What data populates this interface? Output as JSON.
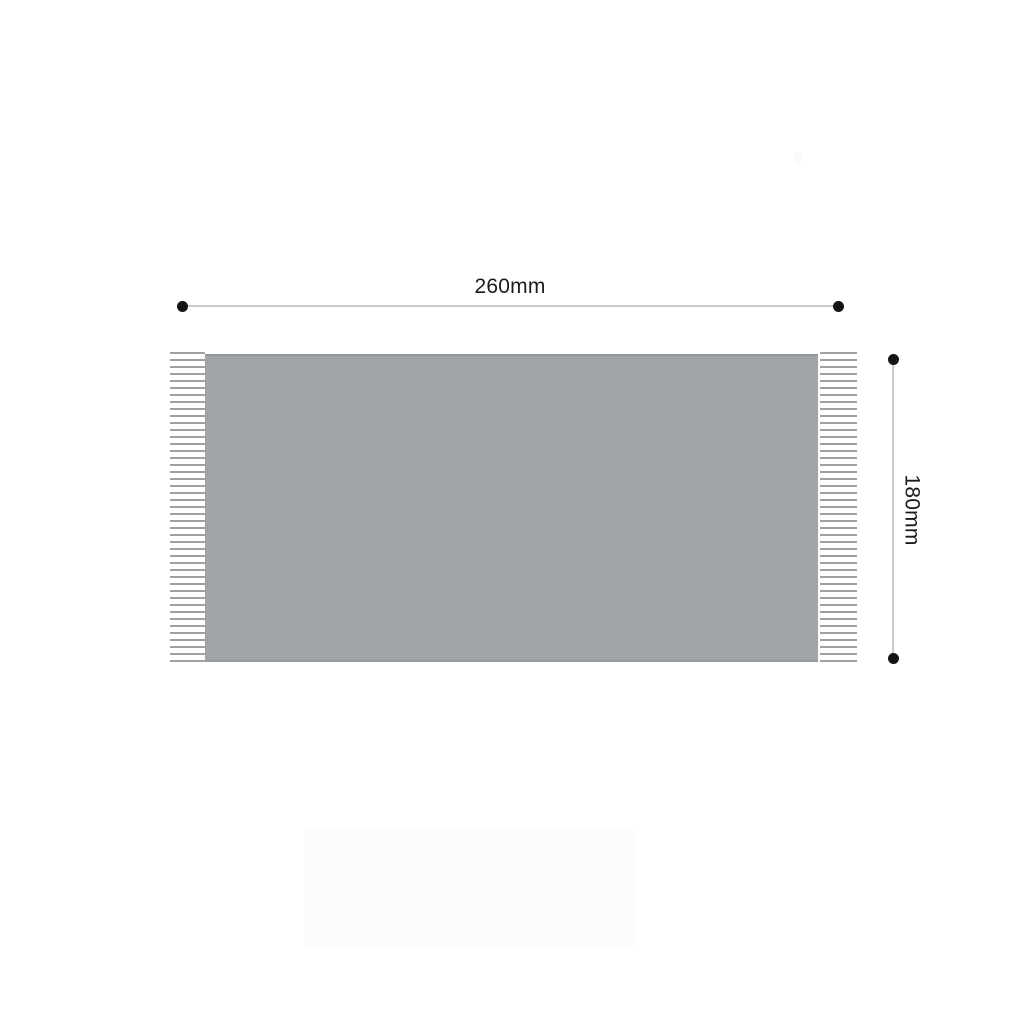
{
  "diagram": {
    "type": "product-dimension-diagram",
    "width_dimension": {
      "label": "260mm"
    },
    "height_dimension": {
      "label": "180mm"
    }
  },
  "colors": {
    "background": "#ffffff",
    "blanket_fill": "#a1a4a7",
    "fringe_line": "#8d9092",
    "dimension_line": "#c9cacb",
    "dimension_dot": "#141414",
    "label_text": "#1b1b1b"
  }
}
